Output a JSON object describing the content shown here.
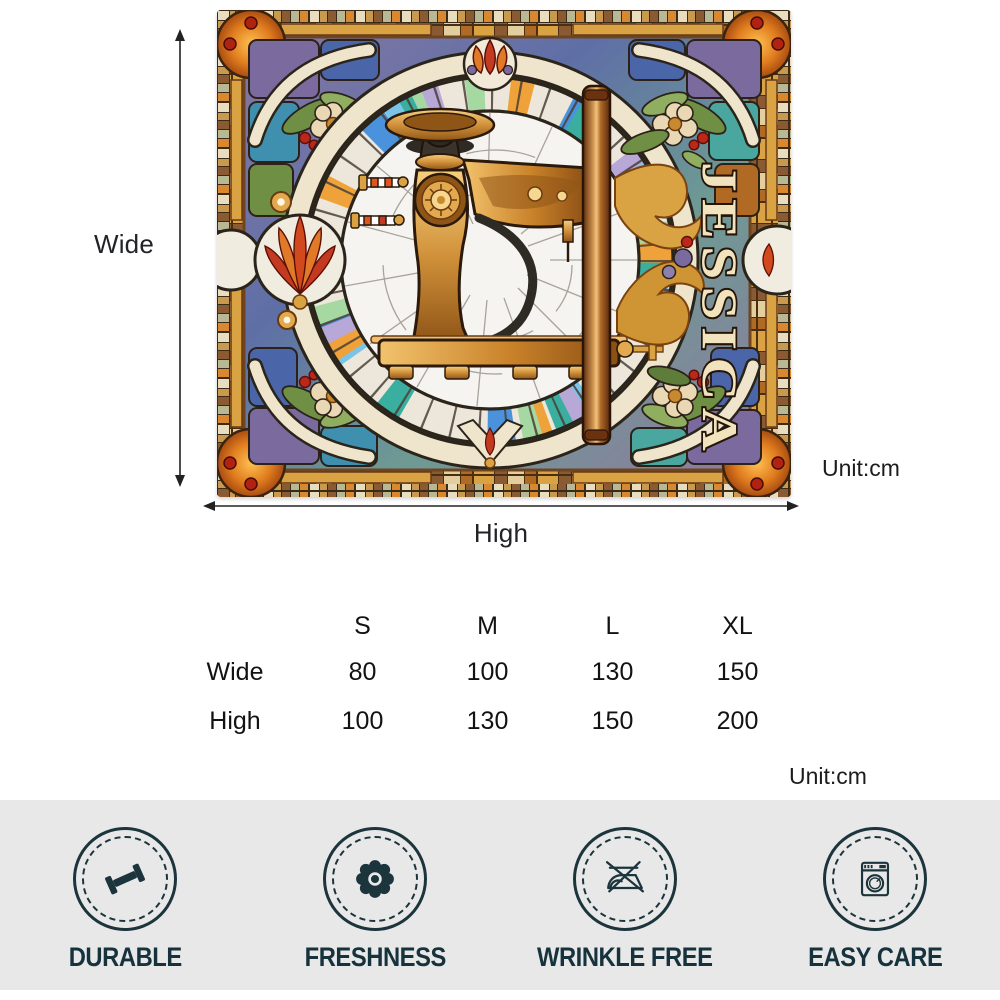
{
  "blanket": {
    "personalized_name": "JESSICA",
    "motif": "stained-glass-sewing-machine",
    "colors": {
      "leading": "#2b241a",
      "cream_ring": "#efe5cc",
      "gold": "#d1913a",
      "accent_red": "#c43a20",
      "accent_blue": "#4a93dc",
      "accent_teal": "#3aaf9f",
      "accent_purple": "#7b6a9e",
      "wood": "#b06a28"
    }
  },
  "dimension_labels": {
    "wide": "Wide",
    "high": "High",
    "unit_top": "Unit:cm",
    "unit_bottom": "Unit:cm"
  },
  "size_table": {
    "columns": [
      "S",
      "M",
      "L",
      "XL"
    ],
    "rows": [
      {
        "label": "Wide",
        "values": [
          "80",
          "100",
          "130",
          "150"
        ]
      },
      {
        "label": "High",
        "values": [
          "100",
          "130",
          "150",
          "200"
        ]
      }
    ]
  },
  "features": [
    {
      "label": "DURABLE",
      "icon": "dumbbell-icon"
    },
    {
      "label": "FRESHNESS",
      "icon": "flower-icon"
    },
    {
      "label": "WRINKLE FREE",
      "icon": "no-iron-icon"
    },
    {
      "label": "EASY CARE",
      "icon": "washing-machine-icon"
    }
  ],
  "feature_bar": {
    "background": "#e8e8e8",
    "ink": "#1c343c"
  }
}
